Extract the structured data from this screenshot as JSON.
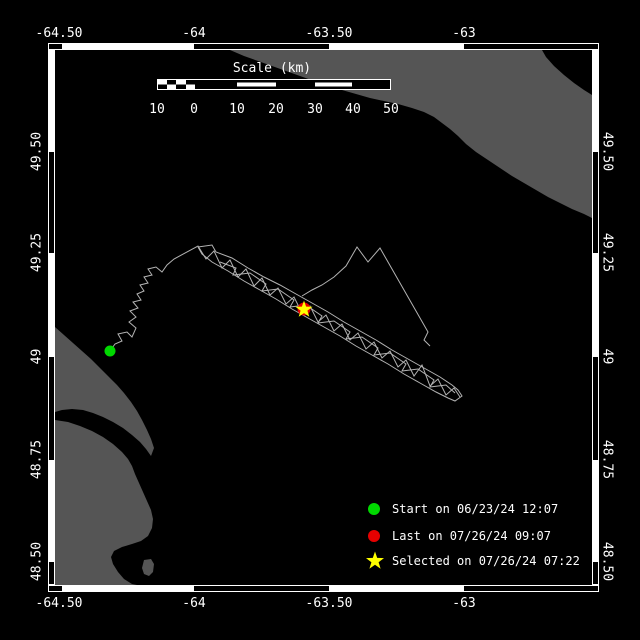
{
  "map": {
    "bg_color": "#000000",
    "frame_color": "#ffffff",
    "land_color": "#555555",
    "axes": {
      "top": [
        "-64.50",
        "-64",
        "-63.50",
        "-63"
      ],
      "bottom": [
        "-64.50",
        "-64",
        "-63.50",
        "-63"
      ],
      "left": [
        "49.50",
        "49.25",
        "49",
        "48.75",
        "48.50"
      ],
      "right": [
        "49.50",
        "49.25",
        "49",
        "48.75",
        "48.50"
      ]
    },
    "land": {
      "anticosti": "230,50 542,50 546,57 554,66 564,75 574,83 584,90 592,95 592,218 584,214 572,209 560,203 548,197 536,190 524,183 512,176 500,168 488,160 476,152 466,144 458,136 450,129 442,123 434,117 424,112 412,108 398,104 384,101 370,98 356,94 342,90 328,86 314,81 300,76 286,71 272,66 258,61 244,56",
      "forillon": "55,327 64,335 73,343 82,351 91,359 100,368 109,377 117,385 124,393 131,402 137,411 142,420 147,430 151,439 154,448 151,456 146,449 140,442 132,435 123,428 113,422 103,417 93,413 83,410 72,409 62,410 55,412",
      "gaspe": "55,420 68,422 80,426 92,431 103,437 113,444 122,452 128,459 132,466 135,474 139,483 143,492 147,501 151,510 153,519 152,528 148,536 141,541 132,544 122,547 114,551 111,557 113,564 118,572 124,579 132,584 142,586 155,587 55,587",
      "island": "144,560 151,559 154,564 153,572 149,576 144,574 142,568"
    }
  },
  "track": {
    "color": "#b3b3b3",
    "strand_a": "110,351 115,344 122,341 118,334 127,332 132,337 136,328 129,322 136,317 130,311 138,308 133,302 141,300 137,294 144,291 140,285 148,283 144,277 152,275 148,269 156,267 162,272 167,265 174,259 198,246 206,259 214,251 222,268 230,260 238,277 246,269 254,286 262,278 270,295 278,288 286,304 294,297 302,313 310,306 318,322 326,315 334,331 342,324 350,340 358,333 366,349 374,342 382,358 390,351 398,367 406,360 414,376 422,365 430,386 438,379 446,395 454,388 460,397",
    "strand_b": "198,247 212,245 216,252 232,258 248,268 264,277 280,285 296,294 312,303 328,312 344,322 360,331 376,340 392,350 408,359 424,368 440,377 452,385 458,390 462,396 455,401 448,398 436,392 420,383 404,374 388,364 372,355 356,346 340,336 324,327 308,318 292,309 276,299 260,290 244,281 228,271 212,262 202,254 198,247",
    "strand_c": "302,296 312,290 322,285 334,277 346,266 357,247 368,262 380,248 388,262 396,276 404,290 412,304 420,318 428,332 424,340 430,346",
    "strand_d": "220,262 236,268 233,275 250,273 266,284 262,291 278,289 294,300 290,307 306,305 322,316 318,323 334,321 350,332 346,339 362,337 378,348 374,355 390,353 406,364 402,371 418,369 434,380 430,387 446,385 455,393"
  },
  "markers": {
    "start": {
      "color": "#00d800"
    },
    "last": {
      "color": "#e60000"
    },
    "selected": {
      "color": "#ffff00",
      "map_star_points": "304,300.5 306.1,306.6 312.6,306.7 307.4,310.6 309.3,316.8 304,313.1 298.7,316.8 300.6,310.6 295.4,306.7 301.9,306.6",
      "legend_star_points": "375,551.5 377.2,557.9 384,558.1 378.6,562.2 380.6,568.7 375,564.8 369.4,568.7 371.4,562.2 366,558.1 372.8,557.9"
    }
  },
  "scalebar": {
    "title": "Scale (km)",
    "labels": [
      "10",
      "0",
      "10",
      "20",
      "30",
      "40",
      "50"
    ]
  },
  "legend": {
    "items": [
      {
        "shape": "circle",
        "color": "#00d800",
        "label": "Start on 06/23/24 12:07"
      },
      {
        "shape": "circle",
        "color": "#e60000",
        "label": "Last on 07/26/24 09:07"
      },
      {
        "shape": "star",
        "color": "#ffff00",
        "label": "Selected on 07/26/24 07:22"
      }
    ]
  }
}
